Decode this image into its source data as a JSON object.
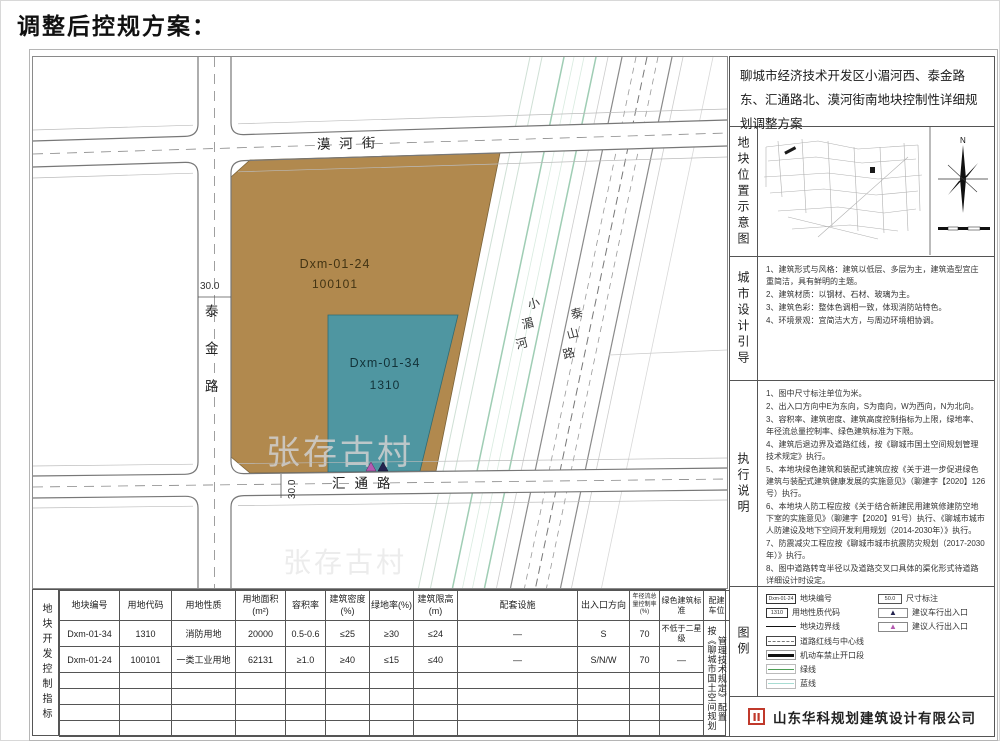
{
  "title": "调整后控规方案：",
  "map": {
    "street_north": "漠河街",
    "street_west_chars": [
      "泰",
      "金",
      "路"
    ],
    "street_south": "汇通路",
    "road_east_chars": [
      "泰",
      "山",
      "路"
    ],
    "river_chars": [
      "小",
      "湄",
      "河"
    ],
    "dim_west": "30.0",
    "dim_south": "30.0",
    "watermark": "张存古村",
    "parcel_brown": {
      "id": "Dxm-01-24",
      "code": "100101"
    },
    "parcel_teal": {
      "id": "Dxm-01-34",
      "code": "1310"
    },
    "colors": {
      "brown": "#b1894e",
      "teal": "#4f96a1"
    }
  },
  "panel": {
    "header": "聊城市经济技术开发区小湄河西、泰金路东、汇通路北、漠河街南地块控制性详细规划调整方案",
    "location_section": {
      "label": "地块位置示意图",
      "compass_n": "N"
    },
    "design_section": {
      "label": "城市设计引导",
      "items": [
        "1、建筑形式与风格：建筑以低层、多层为主，建筑造型宜庄重简洁，具有鲜明的主题。",
        "2、建筑材质：以钢材、石材、玻璃为主。",
        "3、建筑色彩：整体色调相一致，体现消防站特色。",
        "4、环境景观：宜简洁大方，与周边环境相协调。"
      ]
    },
    "execution_section": {
      "label": "执行说明",
      "items": [
        "1、图中尺寸标注单位为米。",
        "2、出入口方向中E为东向，S为南向，W为西向，N为北向。",
        "3、容积率、建筑密度、建筑高度控制指标为上限，绿地率、年径流总量控制率、绿色建筑标准为下限。",
        "4、建筑后退边界及道路红线，按《聊城市国土空间规划管理技术规定》执行。",
        "5、本地块绿色建筑和装配式建筑应按《关于进一步促进绿色建筑与装配式建筑健康发展的实施意见》（聊建字【2020】126号）执行。",
        "6、本地块人防工程应按《关于结合新建民用建筑修建防空地下室的实施意见》（聊建字【2020】91号）执行、《聊城市城市人防建设及地下空间开发利用规划（2014-2030年）》执行。",
        "7、防震减灾工程应按《聊城市城市抗震防灾规划（2017-2030年）》执行。",
        "8、图中道路转弯半径以及道路交叉口具体的渠化形式待道路详细设计时设定。"
      ]
    },
    "legend_section": {
      "label": "图例",
      "left_items": [
        {
          "label": "地块编号",
          "sample": "Dxm-01-24"
        },
        {
          "label": "用地性质代码",
          "sample": "1310"
        },
        {
          "label": "地块边界线"
        },
        {
          "label": "道路红线与中心线"
        },
        {
          "label": "机动车禁止开口段"
        },
        {
          "label": "绿线"
        },
        {
          "label": "蓝线"
        }
      ],
      "right_items": [
        {
          "label": "尺寸标注",
          "sample": "50.0"
        },
        {
          "label": "建议车行出入口"
        },
        {
          "label": "建议人行出入口"
        }
      ]
    },
    "company": "山东华科规划建筑设计有限公司"
  },
  "table": {
    "side_label": "地块开发控制指标",
    "headers": [
      "地块编号",
      "用地代码",
      "用地性质",
      "用地面积(m²)",
      "容积率",
      "建筑密度(%)",
      "绿地率(%)",
      "建筑限高(m)",
      "配套设施",
      "出入口方向",
      "年径流总量控制率(%)",
      "绿色建筑标准",
      "配建车位"
    ],
    "rows": [
      [
        "Dxm-01-34",
        "1310",
        "消防用地",
        "20000",
        "0.5-0.6",
        "≤25",
        "≥30",
        "≤24",
        "—",
        "S",
        "70",
        "不低于二星级"
      ],
      [
        "Dxm-01-24",
        "100101",
        "一类工业用地",
        "62131",
        "≥1.0",
        "≥40",
        "≤15",
        "≤40",
        "—",
        "S/N/W",
        "70",
        "—"
      ]
    ],
    "parking_note": "按《聊城市国土空间规划管理技术规定》配置"
  }
}
